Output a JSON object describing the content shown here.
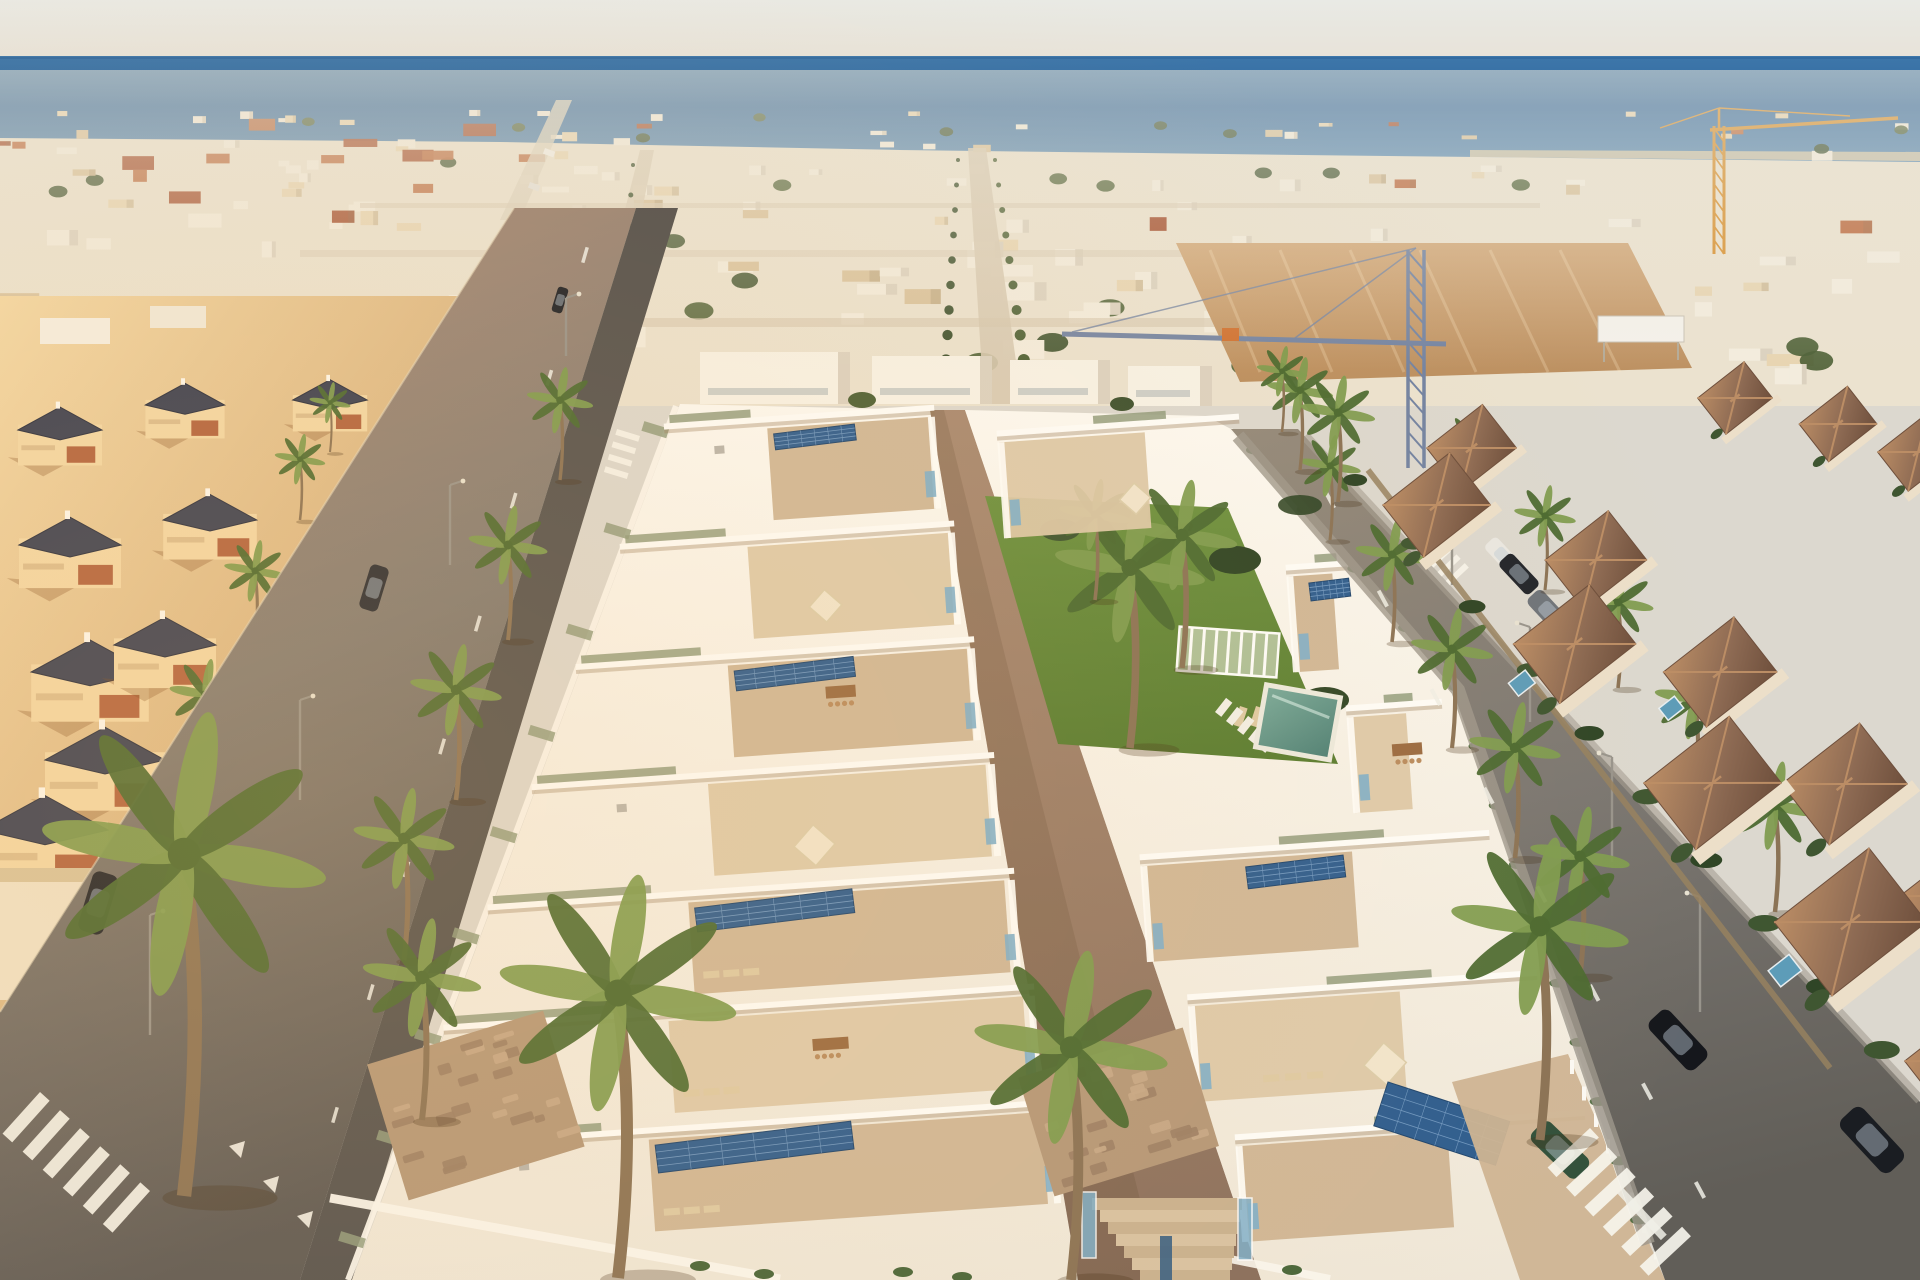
{
  "meta": {
    "image_type": "aerial 3D architectural render photograph",
    "description": "Bird's-eye golden-hour view of a new-build complex of modern white villas with solar panels and a communal pool, set inside a dense Mediterranean coastal town with the deep blue sea along the horizon.",
    "time_of_day": "late afternoon golden hour",
    "no_visible_text": true
  },
  "scene": {
    "sea": "deep blue band across the top under a pale hazy sky",
    "skyline": "dense low-rise white and cream town with scattered red tile roofs and palms",
    "landmarks": {
      "blue_tower_crane": "centre-right middle distance with long jib over the new development",
      "orange_tower_crane": "upper right near the shoreline",
      "vacant_sandy_lot": "centre-right middle distance with a small white sign board"
    },
    "development": {
      "style": "two rows of modern flat-roof white villas separated by a paved central walkway",
      "features": [
        "rooftop terraces with parasols and wooden dining sets",
        "dark-blue solar panel arrays",
        "sky-blue glass balustrades",
        "stone-clad street-level walls",
        "white perimeter walls",
        "entrance stairs with blue glass"
      ],
      "communal_garden": [
        "lawn",
        "tall palms",
        "white slatted pergola",
        "sun loungers",
        "teal rectangular swimming pool"
      ]
    },
    "left_neighbourhood": "warm cream Mediterranean villas with dark slate pyramid roofs and terracotta terraces, lit by low golden sun",
    "right_neighbourhood": "terracotta-roofed townhouses with stone garden walls, hedges and small private plunge pools",
    "streets": {
      "left_street": [
        "dashed centre line",
        "give-way triangles",
        "zebra crossing at bottom-left",
        "two parked dark cars",
        "street lamps",
        "palm-lined sidewalk"
      ],
      "right_street": [
        "zebra crossing near the top",
        "zebra crossing at bottom-right",
        "dashed centre line",
        "parked white car, dark car and grey SUV",
        "black cars at bottom",
        "four street lamps",
        "palms on both sides"
      ]
    },
    "vehicles": [
      {
        "color": "dark green",
        "location": "driveway of the right villa block"
      },
      {
        "color": "black",
        "location": "left street"
      },
      {
        "color": "black",
        "location": "right street bottom"
      },
      {
        "color": "white",
        "location": "right street"
      },
      {
        "color": "grey",
        "location": "right street"
      }
    ],
    "vegetation": {
      "foreground_palms": 5,
      "street_palms": "many",
      "hedges": "clipped grey-green and dark green"
    }
  },
  "palette": {
    "sky_top": "#e9eae5",
    "sky_low": "#e7e1d6",
    "sea_deep": "#30679e",
    "sea_mid": "#3e77aa",
    "sea_light": "#6b97ba",
    "shore": "#d8c9a8",
    "town_base": "#ebe2cf",
    "town_white": "#f3ecdd",
    "town_cream": "#e8d5b2",
    "town_tan": "#d9c29c",
    "roof_red": "#a34d2d",
    "roof_red2": "#bc6a3f",
    "tree": "#4f6238",
    "tree_dark": "#3f5230",
    "sand_top": "#d2a879",
    "sand_low": "#bb8f60",
    "road_tan": "#b2907a",
    "road_mid": "#837c74",
    "road_dark": "#5d5955",
    "streetr_top": "#93897b",
    "streetr_mid": "#7b7772",
    "streetr_low": "#615e58",
    "sidewalk_dark": "#565350",
    "path_top": "#a98a72",
    "path_low": "#8a6f5d",
    "block_top": "#fcf9f2",
    "block_low": "#efe7d8",
    "terrace": "#cdb493",
    "terrace_l": "#dcc8a8",
    "stone": "#b59879",
    "solar": "#2e5d8f",
    "solar_d": "#1f456e",
    "solar_line": "#6f97c0",
    "glass": "#7fafca",
    "navy": "#3a6183",
    "lawn": "#6d9140",
    "lawn_dark": "#587c31",
    "pool": "#4d8076",
    "pool_light": "#78a99a",
    "palm_green": "#4c6a31",
    "palm_light": "#7f9c50",
    "palm_trunk": "#8b7356",
    "crane_blue": "#7383a2",
    "crane_orange": "#d8902e",
    "car_dark": "#22252b",
    "car_green": "#32513b",
    "car_white": "#e9e7e1",
    "car_silver": "#6f747a",
    "beige_sun": "#f3d8a6",
    "beige_shade": "#c99e6c",
    "broof": "#3d4254",
    "bterr": "#ac5936",
    "btrim": "#dcbd8e",
    "hroof": "#8d6a53",
    "hroof_l": "#bb8d65",
    "hroof_d": "#6e4f3c",
    "hwall": "#ecdfc9",
    "haze": "#eae5d7",
    "sun": "#ffc06a",
    "wall_white": "#fbf7ef",
    "fence_white": "#fbf9f3",
    "wood": "#9a6b42",
    "wood_l": "#b98c5f",
    "lounger_tan": "#decaa4",
    "lounger_white": "#f2efe7",
    "planter": "#929c7e",
    "shrub": "#49663a",
    "hedge_l": "#3f5631",
    "hedge_d": "#2f4526",
    "pool_small": "#5d9cb8",
    "step_l": "#d8c2a2",
    "step_d": "#c9b190",
    "stone_l": "#c6a988",
    "stone_d": "#9c8066",
    "lamp_pole": "#98948c"
  }
}
